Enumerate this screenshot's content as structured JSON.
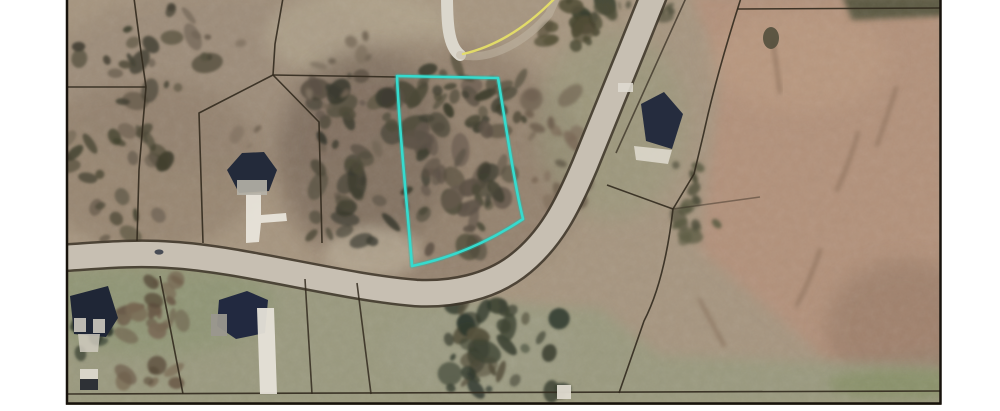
{
  "window": {
    "background": "#ffffff"
  },
  "map_data": {
    "type": "aerial-parcel-map",
    "frame": {
      "x": 66,
      "y": 0,
      "width": 875,
      "height": 405
    },
    "palette": {
      "page_bg": "#ffffff",
      "terrain_base": "#a6957f",
      "road_fill": "#c7bfb2",
      "road_edge": "#3e362a",
      "parcel_line": "#322a1e",
      "highlight": "#35dbce",
      "highlight_glow": "#1fb9ac",
      "street_line_yellow": "#e5de67",
      "border": "#17120c"
    },
    "zones": [
      {
        "name": "zone-topleft-mottle",
        "shape": "ellipse",
        "cx": 230,
        "cy": 80,
        "rx": 185,
        "ry": 95,
        "fill": "#9b8a77",
        "opacity": 0.75,
        "blur": 8
      },
      {
        "name": "zone-left-brush",
        "shape": "ellipse",
        "cx": 150,
        "cy": 165,
        "rx": 115,
        "ry": 85,
        "fill": "#8f7d69",
        "opacity": 0.6,
        "blur": 8
      },
      {
        "name": "zone-top-center-pale",
        "shape": "ellipse",
        "cx": 360,
        "cy": 35,
        "rx": 95,
        "ry": 45,
        "fill": "#b3a78f",
        "opacity": 0.65,
        "blur": 8
      },
      {
        "name": "zone-center-brush",
        "shape": "ellipse",
        "cx": 430,
        "cy": 165,
        "rx": 155,
        "ry": 125,
        "fill": "#8b7866",
        "opacity": 0.65,
        "blur": 10
      },
      {
        "name": "zone-center-dark",
        "shape": "ellipse",
        "cx": 365,
        "cy": 150,
        "rx": 85,
        "ry": 100,
        "fill": "#6f6152",
        "opacity": 0.45,
        "blur": 10
      },
      {
        "name": "zone-field",
        "shape": "polygon",
        "points": [
          [
            690,
            -5
          ],
          [
            945,
            -5
          ],
          [
            945,
            350
          ],
          [
            830,
            362
          ],
          [
            700,
            250
          ],
          [
            722,
            70
          ]
        ],
        "fill": "#b2917a",
        "opacity": 1,
        "blur": 6
      },
      {
        "name": "zone-field-top-pale",
        "shape": "ellipse",
        "cx": 800,
        "cy": 60,
        "rx": 90,
        "ry": 50,
        "fill": "#bd9c82",
        "opacity": 0.55,
        "blur": 10
      },
      {
        "name": "zone-field-shade",
        "shape": "ellipse",
        "cx": 905,
        "cy": 330,
        "rx": 80,
        "ry": 70,
        "fill": "#8f7360",
        "opacity": 0.5,
        "blur": 10
      },
      {
        "name": "zone-grass-bottom",
        "shape": "polygon",
        "points": [
          [
            60,
            270
          ],
          [
            300,
            277
          ],
          [
            430,
            300
          ],
          [
            600,
            308
          ],
          [
            660,
            355
          ],
          [
            945,
            368
          ],
          [
            945,
            410
          ],
          [
            60,
            410
          ]
        ],
        "fill": "#9a9a7e",
        "opacity": 0.95,
        "blur": 6
      },
      {
        "name": "zone-grass-left",
        "shape": "ellipse",
        "cx": 150,
        "cy": 305,
        "rx": 125,
        "ry": 50,
        "fill": "#8d9472",
        "opacity": 0.7,
        "blur": 8
      },
      {
        "name": "zone-grass-right-house",
        "shape": "ellipse",
        "cx": 612,
        "cy": 125,
        "rx": 75,
        "ry": 95,
        "fill": "#969a7a",
        "opacity": 0.5,
        "blur": 10
      },
      {
        "name": "zone-pale-left-of-lot",
        "shape": "ellipse",
        "cx": 372,
        "cy": 252,
        "rx": 48,
        "ry": 26,
        "fill": "#c2b7a0",
        "opacity": 0.6,
        "blur": 6
      },
      {
        "name": "zone-ne-tree-band",
        "shape": "polygon",
        "points": [
          [
            842,
            -4
          ],
          [
            945,
            -4
          ],
          [
            945,
            16
          ],
          [
            852,
            20
          ]
        ],
        "fill": "#4d4f38",
        "opacity": 0.85,
        "blur": 3
      },
      {
        "name": "zone-grass-br-strip",
        "shape": "ellipse",
        "cx": 902,
        "cy": 384,
        "rx": 75,
        "ry": 15,
        "fill": "#879066",
        "opacity": 0.8,
        "blur": 5
      },
      {
        "name": "zone-bottom-center",
        "shape": "ellipse",
        "cx": 480,
        "cy": 350,
        "rx": 95,
        "ry": 45,
        "fill": "#9d9c84",
        "opacity": 0.7,
        "blur": 8
      }
    ],
    "tree_clusters": [
      {
        "name": "trees-subject-lot",
        "cx": 458,
        "cy": 168,
        "rx": 52,
        "ry": 85,
        "count": 60,
        "rmin": 3,
        "rmax": 9,
        "colors": [
          "#4f4b3a",
          "#3e3e30",
          "#5c5246",
          "#675a4e"
        ],
        "seed": 7,
        "blur": 1.4
      },
      {
        "name": "trees-subject-north",
        "cx": 470,
        "cy": 95,
        "rx": 55,
        "ry": 30,
        "count": 22,
        "rmin": 3,
        "rmax": 8,
        "colors": [
          "#4a4736",
          "#3c3c2e"
        ],
        "seed": 37,
        "blur": 1.4
      },
      {
        "name": "trees-west-of-lot",
        "cx": 352,
        "cy": 160,
        "rx": 42,
        "ry": 85,
        "count": 48,
        "rmin": 3,
        "rmax": 9,
        "colors": [
          "#4f4b3a",
          "#3a3a2e",
          "#5c5246"
        ],
        "seed": 11,
        "blur": 1.4
      },
      {
        "name": "trees-topleft",
        "cx": 140,
        "cy": 55,
        "rx": 70,
        "ry": 48,
        "count": 26,
        "rmin": 3,
        "rmax": 8,
        "colors": [
          "#55503d",
          "#464335",
          "#6b5f50"
        ],
        "seed": 3,
        "blur": 1.4
      },
      {
        "name": "trees-left-mid",
        "cx": 115,
        "cy": 185,
        "rx": 55,
        "ry": 55,
        "count": 26,
        "rmin": 3,
        "rmax": 8,
        "colors": [
          "#514c3b",
          "#42402f",
          "#6b5f50"
        ],
        "seed": 5,
        "blur": 1.4
      },
      {
        "name": "trees-road-top",
        "cx": 572,
        "cy": 22,
        "rx": 36,
        "ry": 26,
        "count": 16,
        "rmin": 3,
        "rmax": 8,
        "colors": [
          "#46452f",
          "#3a3f2e",
          "#555039"
        ],
        "seed": 9,
        "blur": 1.4
      },
      {
        "name": "brush-east-of-lot",
        "cx": 556,
        "cy": 150,
        "rx": 32,
        "ry": 58,
        "count": 26,
        "rmin": 3,
        "rmax": 8,
        "colors": [
          "#6e604f",
          "#57503f",
          "#7c6a58"
        ],
        "seed": 13,
        "blur": 1.6
      },
      {
        "name": "trees-bottom-center",
        "cx": 505,
        "cy": 348,
        "rx": 58,
        "ry": 48,
        "count": 42,
        "rmin": 3,
        "rmax": 9,
        "colors": [
          "#3f4434",
          "#30392d",
          "#55503c"
        ],
        "seed": 17,
        "blur": 1.4
      },
      {
        "name": "trees-between-houses",
        "cx": 152,
        "cy": 335,
        "rx": 32,
        "ry": 55,
        "count": 30,
        "rmin": 3,
        "rmax": 8,
        "colors": [
          "#6b5c49",
          "#584b3a",
          "#796a55"
        ],
        "seed": 19,
        "blur": 1.4
      },
      {
        "name": "trees-right-of-road",
        "cx": 700,
        "cy": 205,
        "rx": 26,
        "ry": 42,
        "count": 14,
        "rmin": 3,
        "rmax": 7,
        "colors": [
          "#5a5a42",
          "#4c4c38"
        ],
        "seed": 21,
        "blur": 1.5
      },
      {
        "name": "scatter-top-center",
        "cx": 310,
        "cy": 95,
        "rx": 85,
        "ry": 60,
        "count": 18,
        "rmin": 2,
        "rmax": 6,
        "colors": [
          "#7e7060",
          "#6f6252"
        ],
        "seed": 23,
        "blur": 1.6
      },
      {
        "name": "trees-bl-corner",
        "cx": 90,
        "cy": 340,
        "rx": 24,
        "ry": 18,
        "count": 10,
        "rmin": 3,
        "rmax": 7,
        "colors": [
          "#3a4232",
          "#2f382c"
        ],
        "seed": 29,
        "blur": 1.4
      },
      {
        "name": "trees-top-edge-mid",
        "cx": 630,
        "cy": 8,
        "rx": 45,
        "ry": 10,
        "count": 12,
        "rmin": 2,
        "rmax": 6,
        "colors": [
          "#4c4c38"
        ],
        "seed": 31,
        "blur": 1.5
      }
    ],
    "field_streaks": {
      "color": "#7d6450",
      "width": 4,
      "opacity": 0.5,
      "blur": 2,
      "paths": [
        "M 858,133 C 851,158 843,176 837,190",
        "M 896,88 C 889,112 882,130 877,145",
        "M 773,42 C 776,62 778,78 780,92",
        "M 820,250 C 812,275 804,292 797,305",
        "M 700,300 C 710,320 718,334 724,345"
      ]
    },
    "roads": {
      "main": {
        "name": "main-road",
        "path": "M 655,-8 C 632,50 605,115 585,165 C 568,205 551,241 516,267 C 489,287 452,295 416,293 C 341,287 242,259 172,255 C 132,252 96,256 60,258",
        "fill_width": 24,
        "edge_width": 29
      },
      "cul_de_sac": {
        "name": "cul-de-sac-road",
        "path": "M 447,-6 C 447,22 448,46 460,55",
        "width": 12,
        "color": "#dbd7cc"
      },
      "spur": {
        "name": "spur-track",
        "path": "M 460,55 C 492,62 527,40 549,14 L 557,-4",
        "width": 8,
        "color": "#c2b8a6",
        "opacity": 0.5
      },
      "yellow_line": {
        "name": "yellow-street-line",
        "path": "M 556,-3 C 532,22 502,45 463,54",
        "width": 2.4
      }
    },
    "parcel_lines": [
      {
        "name": "lot-line-topleft-diagonal",
        "path": "M 134,-2 L 141,52 L 146,87 L 139,170 L 137,241",
        "opacity": 0.9
      },
      {
        "name": "lot-line-left-horizontal",
        "path": "M 64,87 L 146,87",
        "opacity": 0.9
      },
      {
        "name": "lot-line-north-vertical",
        "path": "M 283,-2 L 275,44 L 273,75",
        "opacity": 0.9
      },
      {
        "name": "lot-line-house-west",
        "path": "M 273,75 L 199,113 L 203,243",
        "opacity": 0.9
      },
      {
        "name": "lot-line-to-subject",
        "path": "M 273,75 L 397,77",
        "opacity": 0.9
      },
      {
        "name": "lot-line-house-east",
        "path": "M 273,75 L 319,122 L 322,243",
        "opacity": 0.9
      },
      {
        "name": "lot-line-topright-horizontal",
        "path": "M 737,9 L 942,8",
        "opacity": 0.9
      },
      {
        "name": "lot-line-field-west",
        "path": "M 741,-2 C 726,45 712,95 704,132 L 694,174 L 673,209",
        "opacity": 0.9
      },
      {
        "name": "lot-line-to-road",
        "path": "M 673,209 L 607,185",
        "opacity": 0.9
      },
      {
        "name": "lot-line-field-south",
        "path": "M 673,209 C 668,252 659,292 644,321 L 619,393",
        "opacity": 0.9
      },
      {
        "name": "lot-line-field-east-faint",
        "path": "M 673,209 L 760,197",
        "opacity": 0.45
      },
      {
        "name": "lot-line-bottom-horizontal",
        "path": "M 64,394 L 942,391",
        "opacity": 0.9
      },
      {
        "name": "lot-line-bottomleft-vertical",
        "path": "M 160,276 L 171,332 L 183,394",
        "opacity": 0.9
      },
      {
        "name": "lot-line-bottom-mid-vertical-a",
        "path": "M 305,279 L 312,394",
        "opacity": 0.85
      },
      {
        "name": "lot-line-bottom-mid-vertical-b",
        "path": "M 357,283 L 371,394",
        "opacity": 0.85
      },
      {
        "name": "lot-line-road-upper-edge",
        "path": "M 686,-2 C 663,48 640,100 616,153",
        "opacity": 0.7
      }
    ],
    "buildings": [
      {
        "name": "house-center-left-roof",
        "points": [
          [
            227,
            170
          ],
          [
            242,
            153
          ],
          [
            264,
            152
          ],
          [
            277,
            170
          ],
          [
            269,
            191
          ],
          [
            239,
            193
          ]
        ],
        "fill": "#232a3a"
      },
      {
        "name": "house-right-roof",
        "points": [
          [
            641,
            104
          ],
          [
            664,
            92
          ],
          [
            683,
            114
          ],
          [
            672,
            149
          ],
          [
            646,
            141
          ]
        ],
        "fill": "#252c3e"
      },
      {
        "name": "house-bottomleft-roof",
        "points": [
          [
            70,
            296
          ],
          [
            108,
            286
          ],
          [
            118,
            318
          ],
          [
            106,
            337
          ],
          [
            74,
            334
          ]
        ],
        "fill": "#1f2636"
      },
      {
        "name": "house-bottom-second-roof",
        "points": [
          [
            219,
            300
          ],
          [
            247,
            291
          ],
          [
            268,
            300
          ],
          [
            265,
            333
          ],
          [
            236,
            339
          ],
          [
            217,
            326
          ]
        ],
        "fill": "#222940"
      }
    ],
    "driveways": [
      {
        "name": "driveway-center-left",
        "points": [
          [
            246,
            194
          ],
          [
            261,
            193
          ],
          [
            261,
            215
          ],
          [
            286,
            213
          ],
          [
            287,
            221
          ],
          [
            261,
            223
          ],
          [
            259,
            242
          ],
          [
            246,
            243
          ]
        ],
        "fill": "#e8e4da",
        "opacity": 0.95
      },
      {
        "name": "driveway-right-house",
        "points": [
          [
            634,
            146
          ],
          [
            672,
            150
          ],
          [
            668,
            164
          ],
          [
            636,
            160
          ]
        ],
        "fill": "#ddd8cc",
        "opacity": 0.9
      },
      {
        "name": "driveway-bottomleft",
        "points": [
          [
            78,
            334
          ],
          [
            100,
            334
          ],
          [
            98,
            352
          ],
          [
            80,
            352
          ]
        ],
        "fill": "#cfcabe",
        "opacity": 0.85
      },
      {
        "name": "driveway-bottom-second",
        "points": [
          [
            257,
            308
          ],
          [
            274,
            308
          ],
          [
            277,
            394
          ],
          [
            260,
            394
          ]
        ],
        "fill": "#e6e2d8",
        "opacity": 0.95
      }
    ],
    "extras": [
      {
        "name": "house1-front",
        "shape": "rect",
        "x": 237,
        "y": 180,
        "w": 30,
        "h": 15,
        "fill": "#b6b2a8",
        "opacity": 0.9
      },
      {
        "name": "house3-garage-a",
        "shape": "rect",
        "x": 74,
        "y": 318,
        "w": 12,
        "h": 14,
        "fill": "#d8d4c8",
        "opacity": 0.85
      },
      {
        "name": "house3-garage-b",
        "shape": "rect",
        "x": 93,
        "y": 319,
        "w": 12,
        "h": 14,
        "fill": "#d8d4c8",
        "opacity": 0.85
      },
      {
        "name": "house4-wing",
        "shape": "rect",
        "x": 211,
        "y": 314,
        "w": 16,
        "h": 22,
        "fill": "#9a978e",
        "opacity": 0.95
      },
      {
        "name": "shed-roof-light",
        "shape": "rect",
        "x": 80,
        "y": 369,
        "w": 18,
        "h": 10,
        "fill": "#d9d5c9",
        "opacity": 1
      },
      {
        "name": "shed-roof-dark",
        "shape": "rect",
        "x": 80,
        "y": 379,
        "w": 18,
        "h": 11,
        "fill": "#2e3136",
        "opacity": 1
      },
      {
        "name": "outbuilding-white",
        "shape": "rect",
        "x": 557,
        "y": 385,
        "w": 14,
        "h": 14,
        "fill": "#dfdbd0",
        "opacity": 0.95
      },
      {
        "name": "white-patch-right-house",
        "shape": "rect",
        "x": 618,
        "y": 83,
        "w": 15,
        "h": 9,
        "fill": "#ded9cf",
        "opacity": 0.9
      },
      {
        "name": "field-lone-tree",
        "shape": "ellipse",
        "cx": 771,
        "cy": 38,
        "rx": 8,
        "ry": 11,
        "fill": "#4c4a38",
        "opacity": 0.85
      },
      {
        "name": "car-on-road",
        "shape": "ellipse",
        "cx": 159,
        "cy": 252,
        "rx": 4.5,
        "ry": 2.6,
        "fill": "#3a3f4a",
        "opacity": 0.9
      }
    ],
    "highlight_parcel": {
      "name": "subject-lot-outline",
      "path": "M 397,76 L 498,78 C 506,126 514,182 523,219 C 487,243 451,258 412,266 C 407,203 399,128 397,76 Z",
      "stroke_width": 2.6
    },
    "border": {
      "path": "M 67,0 L 67,403.5 L 940.5,403.5 L 940.5,0",
      "width": 2.5
    }
  }
}
